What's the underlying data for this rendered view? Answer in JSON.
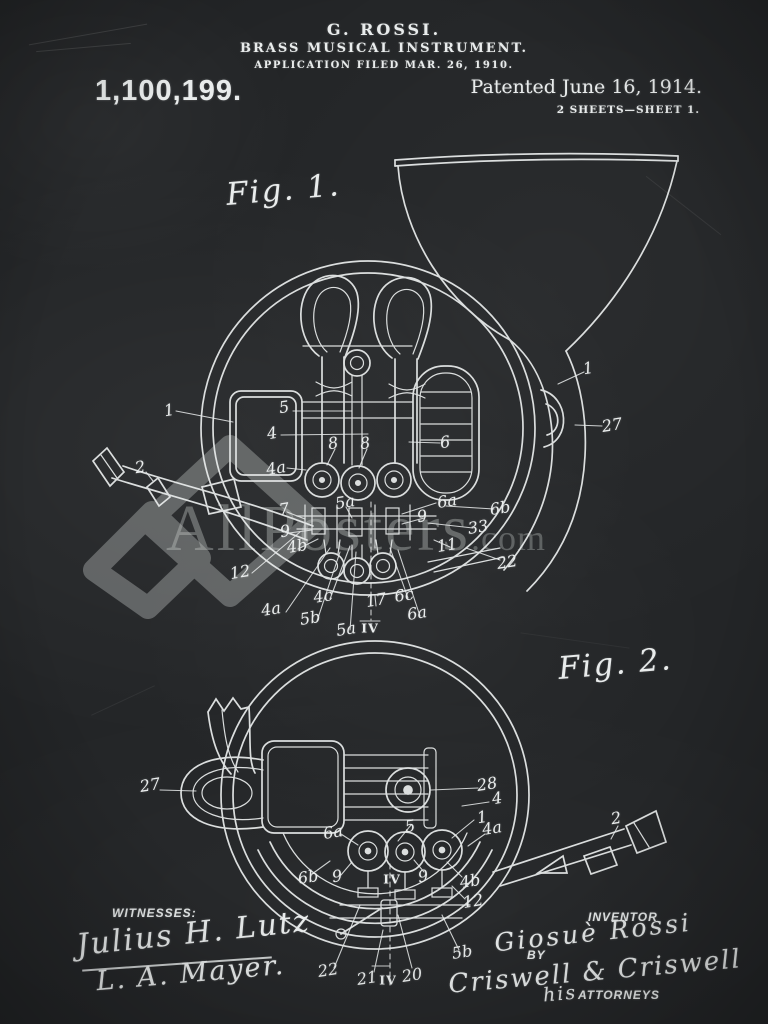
{
  "poster": {
    "header": {
      "inventor_line": "G. ROSSI.",
      "title_line": "BRASS MUSICAL INSTRUMENT.",
      "application_line": "APPLICATION FILED MAR. 26, 1910.",
      "patent_number": "1,100,199.",
      "patented_line": "Patented June 16, 1914.",
      "sheet_line": "2 SHEETS—SHEET 1."
    },
    "figures": [
      {
        "id": "fig1",
        "label": "Fig. 1.",
        "annotations": [
          {
            "t": "1",
            "x": 169,
            "y": 410
          },
          {
            "t": "2",
            "x": 140,
            "y": 467
          },
          {
            "t": "5",
            "x": 284,
            "y": 407
          },
          {
            "t": "4",
            "x": 272,
            "y": 433
          },
          {
            "t": "4a",
            "x": 276,
            "y": 468
          },
          {
            "t": "8",
            "x": 333,
            "y": 443
          },
          {
            "t": "8",
            "x": 365,
            "y": 443
          },
          {
            "t": "6",
            "x": 445,
            "y": 442
          },
          {
            "t": "1",
            "x": 588,
            "y": 368
          },
          {
            "t": "27",
            "x": 612,
            "y": 425
          },
          {
            "t": "7",
            "x": 284,
            "y": 509
          },
          {
            "t": "9",
            "x": 285,
            "y": 531
          },
          {
            "t": "4b",
            "x": 297,
            "y": 546
          },
          {
            "t": "12",
            "x": 240,
            "y": 572
          },
          {
            "t": "5a",
            "x": 345,
            "y": 502
          },
          {
            "t": "9",
            "x": 422,
            "y": 516
          },
          {
            "t": "6a",
            "x": 447,
            "y": 501
          },
          {
            "t": "6b",
            "x": 500,
            "y": 508
          },
          {
            "t": "33",
            "x": 478,
            "y": 527
          },
          {
            "t": "11",
            "x": 447,
            "y": 545
          },
          {
            "t": "22",
            "x": 507,
            "y": 562
          },
          {
            "t": "4a",
            "x": 271,
            "y": 609
          },
          {
            "t": "5b",
            "x": 310,
            "y": 618
          },
          {
            "t": "4c",
            "x": 323,
            "y": 596
          },
          {
            "t": "5a",
            "x": 346,
            "y": 629
          },
          {
            "t": "17",
            "x": 376,
            "y": 600
          },
          {
            "t": "IV",
            "x": 370,
            "y": 628
          },
          {
            "t": "6c",
            "x": 404,
            "y": 595
          },
          {
            "t": "6a",
            "x": 417,
            "y": 613
          }
        ]
      },
      {
        "id": "fig2",
        "label": "Fig. 2.",
        "annotations": [
          {
            "t": "27",
            "x": 150,
            "y": 785
          },
          {
            "t": "6a",
            "x": 333,
            "y": 832
          },
          {
            "t": "5",
            "x": 410,
            "y": 826
          },
          {
            "t": "28",
            "x": 487,
            "y": 784
          },
          {
            "t": "4",
            "x": 497,
            "y": 798
          },
          {
            "t": "1",
            "x": 482,
            "y": 817
          },
          {
            "t": "4a",
            "x": 492,
            "y": 828
          },
          {
            "t": "2",
            "x": 616,
            "y": 818
          },
          {
            "t": "6b",
            "x": 308,
            "y": 877
          },
          {
            "t": "9",
            "x": 337,
            "y": 876
          },
          {
            "t": "IV",
            "x": 392,
            "y": 879
          },
          {
            "t": "9",
            "x": 423,
            "y": 876
          },
          {
            "t": "4b",
            "x": 470,
            "y": 881
          },
          {
            "t": "12",
            "x": 473,
            "y": 901
          },
          {
            "t": "5b",
            "x": 462,
            "y": 952
          },
          {
            "t": "22",
            "x": 328,
            "y": 970
          },
          {
            "t": "21",
            "x": 367,
            "y": 978
          },
          {
            "t": "IV",
            "x": 388,
            "y": 980
          },
          {
            "t": "20",
            "x": 412,
            "y": 975
          }
        ]
      }
    ],
    "watermark": {
      "brand": "AllPosters",
      "tld": ".com"
    },
    "signatures": {
      "witnesses_label": "WITNESSES:",
      "witness_1": "Julius H. Lutz",
      "witness_2": "L. A. Mayer.",
      "inventor_label": "INVENTOR",
      "inventor_name": "Giosuè Rossi",
      "by_label": "BY",
      "attorney_name": "Criswell & Criswell",
      "his_label": "his",
      "attorneys_label": "ATTORNEYS"
    },
    "colors": {
      "background": "#232527",
      "chalk": "#e9ecec",
      "watermark_text": "#c8ccca",
      "watermark_logo": "#a9adac"
    }
  }
}
